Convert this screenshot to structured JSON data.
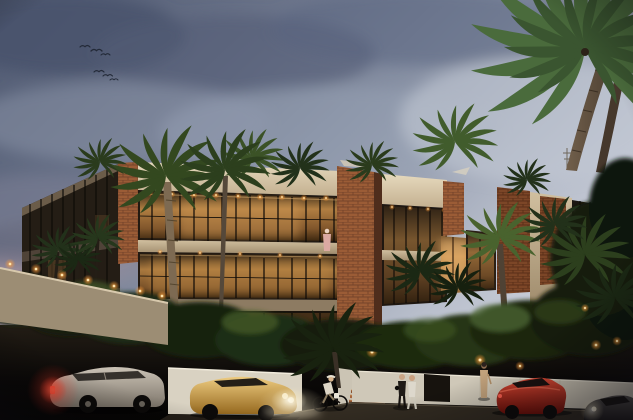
{
  "scene": {
    "type": "architectural-rendering",
    "description": "Dusk exterior rendering of a modern tropical three-story condominium with cream stucco volumes, red brick piers and warmly lit glass walls, surrounded by palm trees; street in front with a parked silver SUV with lit taillights, a gold sedan with headlights on, a red sports car, a dark car entering at bottom right, pedestrians, a cyclist, and birds in a cloudy blue-gray evening sky",
    "time_of_day": "dusk",
    "weather": "partly cloudy",
    "birds_count": 6,
    "building": {
      "style": "modern tropical condominium",
      "floors": 3,
      "materials": [
        "cream stucco",
        "red brick",
        "dark glass",
        "warm interior lighting"
      ],
      "features": [
        "rooftop palm garden",
        "white shade canopies",
        "recessed ceiling downlights",
        "balcony with standing figure"
      ]
    },
    "vehicles": [
      {
        "name": "silver-suv",
        "state": "parked, red taillights glowing",
        "color_key": "car_silver"
      },
      {
        "name": "gold-sedan",
        "state": "headlights on, facing left",
        "color_key": "car_gold"
      },
      {
        "name": "red-sports-car",
        "state": "driving right",
        "color_key": "car_red"
      },
      {
        "name": "dark-car",
        "state": "entering frame bottom-right, headlight glow",
        "color_key": "car_dark"
      }
    ],
    "people": [
      {
        "name": "walking-couple",
        "detail": "one in dark clothes, one in white"
      },
      {
        "name": "woman-long-dress",
        "detail": "standing by the white wall"
      },
      {
        "name": "cyclist",
        "detail": "white shirt, riding along sidewalk"
      },
      {
        "name": "balcony-figure",
        "detail": "standing at second floor glass"
      }
    ],
    "vegetation": [
      "large coconut palm top right",
      "royal palms in front of facade",
      "rooftop palms",
      "dark tropical shrubs with landscape uplights"
    ],
    "lighting": [
      "pink sunset glow at left horizon",
      "warm amber interior light",
      "orange garden uplights",
      "white headlight pools on street"
    ]
  },
  "palette": {
    "sky_top": "#4e5870",
    "sky_mid": "#8b94a7",
    "sky_light": "#d3d7e0",
    "horizon_pink": "#c9a2a6",
    "cloud_dark": "#49536a",
    "stucco_bright": "#e6d9bd",
    "stucco_shadow": "#9a8a6e",
    "brick": "#9b5c36",
    "brick_dark": "#6e3d22",
    "glass_dark": "#231a11",
    "window_warm": "#c08947",
    "window_glow": "#e8b877",
    "palm_dark": "#1e2b16",
    "palm_mid": "#33481f",
    "palm_light": "#4c6531",
    "trunk": "#6b5a47",
    "street": "#0a0807",
    "wall_white": "#d9d2c2",
    "uplight": "#ff9d3a",
    "car_silver": "#cbc3b6",
    "car_gold": "#e3bc6a",
    "car_red": "#d0261a",
    "car_dark": "#4a4644",
    "taillight": "#ff4030",
    "headlight": "#fff4d8"
  }
}
